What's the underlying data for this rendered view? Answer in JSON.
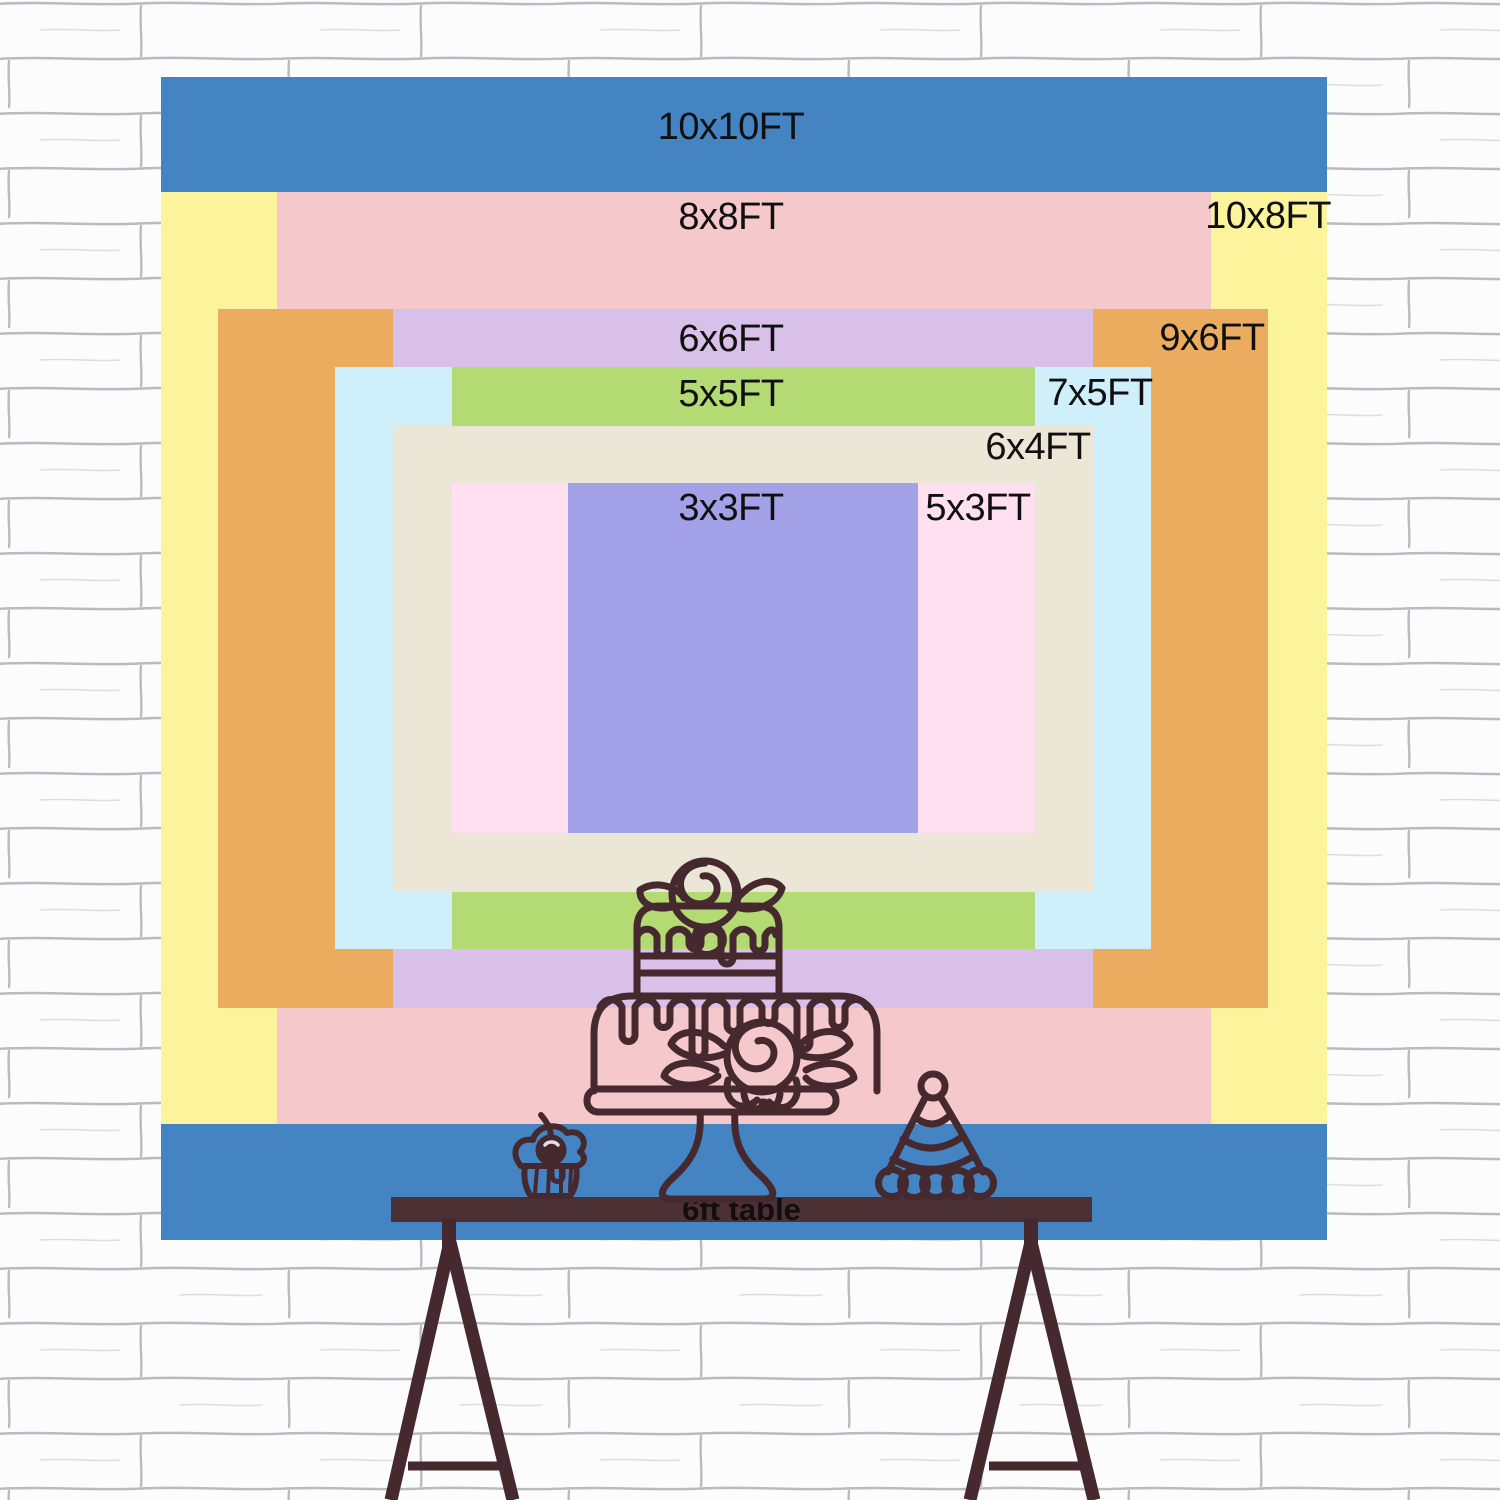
{
  "backdrop": {
    "label_color": "#101010",
    "layers": [
      {
        "name": "10x10ft",
        "label": "10x10FT",
        "color": "#4484c3",
        "rect": {
          "left": 161,
          "top": 77,
          "width": 1166,
          "height": 1163
        },
        "label_pos": {
          "x": 731,
          "y": 127
        }
      },
      {
        "name": "10x8ft",
        "label": "10x8FT",
        "color": "#fcf49c",
        "rect": {
          "left": 161,
          "top": 192,
          "width": 1166,
          "height": 932
        },
        "label_pos": {
          "x": 1268,
          "y": 216
        }
      },
      {
        "name": "8x8ft",
        "label": "8x8FT",
        "color": "#f5c9cb",
        "rect": {
          "left": 277,
          "top": 192,
          "width": 934,
          "height": 932
        },
        "label_pos": {
          "x": 731,
          "y": 217
        }
      },
      {
        "name": "9x6ft",
        "label": "9x6FT",
        "color": "#ebac5f",
        "rect": {
          "left": 218,
          "top": 309,
          "width": 1050,
          "height": 699
        },
        "label_pos": {
          "x": 1212,
          "y": 338
        }
      },
      {
        "name": "6x6ft",
        "label": "6x6FT",
        "color": "#d8c0e9",
        "rect": {
          "left": 393,
          "top": 309,
          "width": 700,
          "height": 699
        },
        "label_pos": {
          "x": 731,
          "y": 339
        }
      },
      {
        "name": "7x5ft",
        "label": "7x5FT",
        "color": "#cfeffa",
        "rect": {
          "left": 335,
          "top": 367,
          "width": 816,
          "height": 582
        },
        "label_pos": {
          "x": 1100,
          "y": 393
        }
      },
      {
        "name": "5x5ft",
        "label": "5x5FT",
        "color": "#b4da74",
        "rect": {
          "left": 452,
          "top": 367,
          "width": 583,
          "height": 582
        },
        "label_pos": {
          "x": 731,
          "y": 394
        }
      },
      {
        "name": "6x4ft",
        "label": "6x4FT",
        "color": "#ebe6d6",
        "rect": {
          "left": 393,
          "top": 426,
          "width": 700,
          "height": 466
        },
        "label_pos": {
          "x": 1038,
          "y": 447
        }
      },
      {
        "name": "5x3ft",
        "label": "5x3FT",
        "color": "#fee0f0",
        "rect": {
          "left": 452,
          "top": 483,
          "width": 583,
          "height": 350
        },
        "label_pos": {
          "x": 978,
          "y": 508
        }
      },
      {
        "name": "3x3ft",
        "label": "3x3FT",
        "color": "#a3a1e8",
        "rect": {
          "left": 568,
          "top": 483,
          "width": 350,
          "height": 350
        },
        "label_pos": {
          "x": 731,
          "y": 508
        }
      }
    ]
  },
  "table": {
    "label": "6ft table",
    "bar_color": "#4c3134",
    "rect": {
      "left": 391,
      "top": 1197,
      "width": 701,
      "height": 25
    }
  },
  "illustration": {
    "stroke": "#46292f",
    "items": [
      "two-tier-cake-on-stand",
      "cupcake-with-cherry",
      "party-hat",
      "trestle-table-legs"
    ]
  },
  "wall": {
    "base": "#fcfcfd",
    "mortar": "#84848c"
  }
}
